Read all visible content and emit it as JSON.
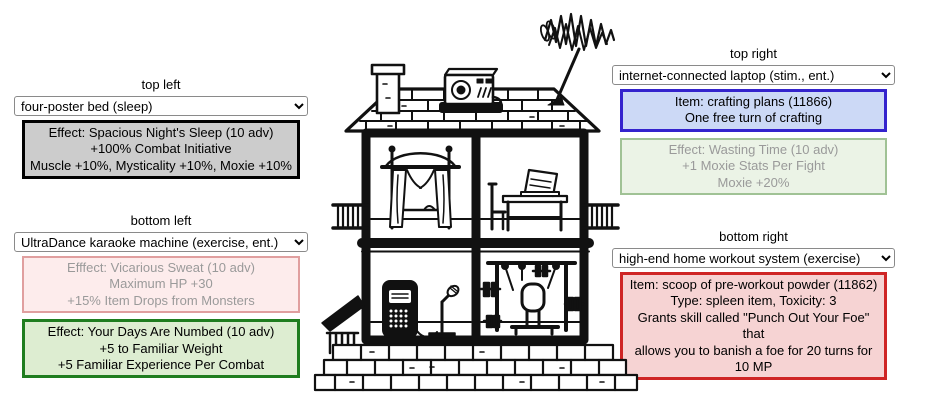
{
  "panels": {
    "top_left": {
      "label": "top left",
      "select": {
        "value": "four-poster bed (sleep)"
      },
      "effect_box": {
        "lines": [
          "Effect: Spacious Night's Sleep (10 adv)",
          "+100% Combat Initiative",
          "Muscle +10%, Mysticality +10%, Moxie +10%"
        ],
        "bg": "#cccccc",
        "border": "#000000",
        "text_color": "#000000",
        "state": "active"
      }
    },
    "top_right": {
      "label": "top right",
      "select": {
        "value": "internet-connected laptop (stim., ent.)"
      },
      "item_box": {
        "lines": [
          "Item: crafting plans (11866)",
          "One free turn of crafting"
        ],
        "bg": "#ccd9f6",
        "border": "#3423cd",
        "text_color": "#000000"
      },
      "effect_box": {
        "lines": [
          "Effect: Wasting Time (10 adv)",
          "+1 Moxie Stats Per Fight",
          "Moxie +20%"
        ],
        "bg": "#ebf3e6",
        "border": "#a0c295",
        "text_color": "#9a9a9a",
        "state": "inactive"
      }
    },
    "bottom_left": {
      "label": "bottom left",
      "select": {
        "value": "UltraDance karaoke machine (exercise, ent.)"
      },
      "effect_box_secondary": {
        "lines": [
          "Efffect: Vicarious Sweat (10 adv)",
          "Maximum HP +30",
          "+15% Item Drops from Monsters"
        ],
        "bg": "#fdecec",
        "border": "#e09f9f",
        "text_color": "#9a9a9a",
        "state": "inactive"
      },
      "effect_box_primary": {
        "lines": [
          "Effect: Your Days Are Numbed (10 adv)",
          "+5 to Familiar Weight",
          "+5 Familiar Experience Per Combat"
        ],
        "bg": "#ddedd1",
        "border": "#1f7d1f",
        "text_color": "#000000",
        "state": "active"
      }
    },
    "bottom_right": {
      "label": "bottom right",
      "select": {
        "value": "high-end home workout system (exercise)"
      },
      "item_box": {
        "lines": [
          "Item: scoop of pre-workout powder (11862)",
          "Type: spleen item, Toxicity: 3",
          "Grants skill called \"Punch Out Your Foe\" that",
          "allows you to banish a foe for 20 turns for 10 MP"
        ],
        "bg": "#f6d3d3",
        "border": "#cf2525",
        "text_color": "#000000"
      }
    }
  },
  "illustration": {
    "name": "two-story house cross-section (hand-drawn)",
    "ink_color": "#111111",
    "parts": [
      "shingled-roof",
      "chimney",
      "roof-radio",
      "tv-antenna",
      "four-poster-bed",
      "desk-with-laptop-and-chair",
      "karaoke-machine-with-microphone",
      "home-gym-machine",
      "side-railings",
      "porch-awning",
      "stone-foundation"
    ]
  }
}
